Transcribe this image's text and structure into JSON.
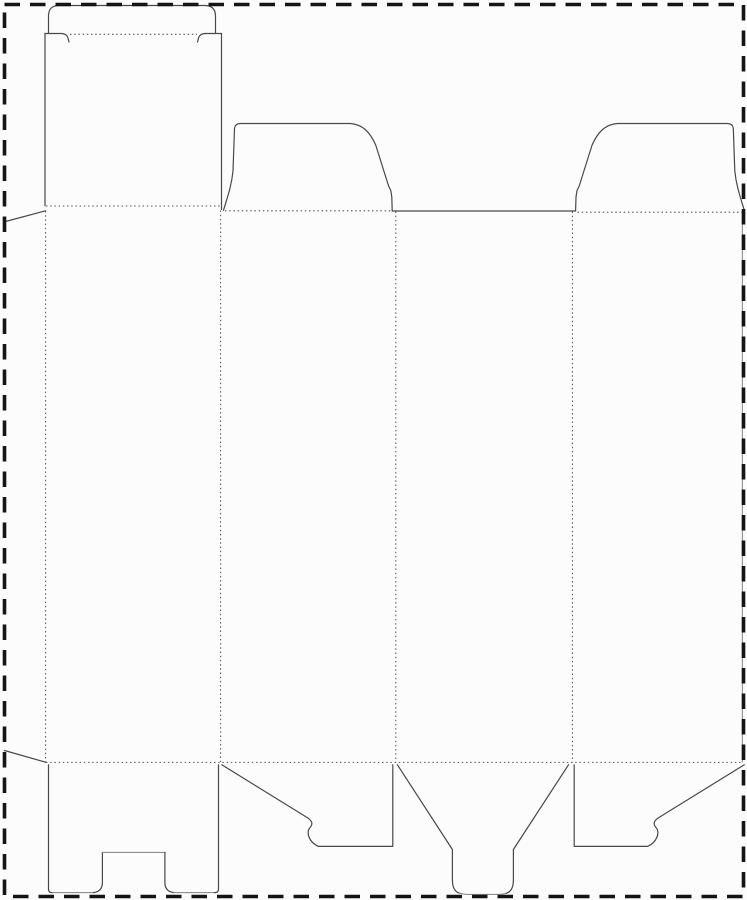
{
  "canvas": {
    "width": 747,
    "height": 900,
    "background": "#fcfcfc"
  },
  "colors": {
    "cut": "#484848",
    "cut_light": "#8e8e8e",
    "fold": "#575757",
    "border": "#151515"
  },
  "sheet_border": {
    "name": "sheet-boundary-border",
    "x": 4.5,
    "y": 4.5,
    "width": 739,
    "height": 892,
    "stroke_width": 3.6,
    "dash": "15.5 10"
  },
  "dieline": {
    "cut_paths": [
      {
        "name": "tuck-flap-outline",
        "d": "M 48.5 33.5 L 48.5 16 Q 48.5 5.5 59 5.5 L 204.5 5.5 Q 215.5 5.5 215.5 16 L 215.5 33.5",
        "light": false
      },
      {
        "name": "tuck-shoulder-left-cut",
        "d": "M 45 33.5 L 61.5 33.5 Q 66.5 33.8 67.8 37.5 L 69 42",
        "light": false
      },
      {
        "name": "tuck-shoulder-right-cut",
        "d": "M 221.5 33.5 L 205 33.5 Q 200 33.8 198.7 37.5 L 197.5 42",
        "light": false
      },
      {
        "name": "top-panel-left-edge",
        "d": "M 45 33.5 L 45 205.8",
        "light": false
      },
      {
        "name": "top-panel-right-edge",
        "d": "M 221.5 33.5 L 221.5 209.5",
        "light": false
      },
      {
        "name": "glue-flap-top-edge",
        "d": "M 45.5 210.8 L 5.5 221.5",
        "light": false
      },
      {
        "name": "glue-flap-bottom-edge",
        "d": "M 4.5 750.5 L 46 762.3",
        "light": false
      },
      {
        "name": "dust-flap-left-outline",
        "d": "M 223.5 210.3 C 227.5 197 231.5 186 233 171 L 234.5 128.5 Q 235 123.5 240.5 123.5 L 350.5 123.5 C 362.5 124.5 370 132 375.7 145 L 388.6 186 L 390.8 190.5 L 391.8 197 L 392.2 210.3",
        "light": false
      },
      {
        "name": "back-panel-top-edge",
        "d": "M 392.2 211 L 575.6 211",
        "light": false
      },
      {
        "name": "dust-flap-right-outline",
        "d": "M 575.6 210.3 L 576 197 L 577 190.5 L 579.2 186 L 592.1 145 C 597.8 132 605.3 124.5 617.3 123.5 L 727.3 123.5 Q 732.8 123.5 733.3 128.5 L 734.8 171 C 736.3 186 740.3 197 744.3 210.3",
        "light": false
      },
      {
        "name": "bottom-flap1-left-edge",
        "d": "M 48.5 764.8 L 48.5 889.5 Q 48.5 892.6 52.5 892.6",
        "light": false
      },
      {
        "name": "bottom-flap1-bottom-left-edge",
        "d": "M 52.5 892.6 L 93.5 892.6",
        "light": true
      },
      {
        "name": "bottom-flap1-notch-left-cut",
        "d": "M 93.5 892.6 Q 102.4 891.5 102.4 882.5 L 102.4 852.4",
        "light": false
      },
      {
        "name": "bottom-flap1-notch-top-cut",
        "d": "M 102.4 852.4 L 164.9 852.4",
        "light": true
      },
      {
        "name": "bottom-flap1-notch-right-cut",
        "d": "M 164.9 852.4 L 164.9 882.5 Q 164.9 891.5 173.8 892.6",
        "light": false
      },
      {
        "name": "bottom-flap1-bottom-right-edge",
        "d": "M 173.8 892.6 L 214.5 892.6",
        "light": true
      },
      {
        "name": "bottom-flap1-right-edge",
        "d": "M 214.5 892.6 Q 218.5 892.6 218.5 889.5 L 218.5 764.8",
        "light": false
      },
      {
        "name": "bottom-flap2-outline",
        "d": "M 221.8 764.8 L 308.3 818.3 C 312 821 313 824 310.5 827 C 308 829.5 307.5 833 309 837 C 310.6 841 313.4 844.2 318.4 846.4 L 392.8 846.4 L 392.8 764.8",
        "light": false
      },
      {
        "name": "bottom-flap3-left-side",
        "d": "M 397.4 764.8 L 452.4 849.5 L 452.4 880 Q 452.4 891 459.5 893.2",
        "light": false
      },
      {
        "name": "bottom-flap3-tongue-bottom",
        "d": "M 459.5 893.2 Q 463 894.4 467 894.4 L 499 894.4 Q 503 894.4 506.4 893.2",
        "light": true
      },
      {
        "name": "bottom-flap3-right-side",
        "d": "M 506.4 893.2 Q 513.4 891 513.4 880 L 513.4 849.5 L 568.5 764.8",
        "light": false
      },
      {
        "name": "bottom-flap4-outline",
        "d": "M 744.3 764.8 L 657.7 818.3 C 654 821 653 824 655.5 827 C 658 829.5 658.5 833 657 837 C 655.4 841 652.6 844.2 647.6 846.4 L 574.2 846.4 L 574.2 764.8",
        "light": false
      },
      {
        "name": "right-panel-outer-edge",
        "d": "M 742.4 212 L 742.4 762",
        "light": true
      }
    ],
    "fold_lines": [
      {
        "name": "tuck-flap-fold",
        "x1": 70,
        "y1": 34.3,
        "x2": 197,
        "y2": 34.3
      },
      {
        "name": "top-panel-fold",
        "x1": 46,
        "y1": 206,
        "x2": 220,
        "y2": 206
      },
      {
        "name": "dust-flap-left-fold",
        "x1": 225,
        "y1": 210.8,
        "x2": 391,
        "y2": 210.8
      },
      {
        "name": "dust-flap-right-fold",
        "x1": 577.5,
        "y1": 212.2,
        "x2": 742,
        "y2": 212.2
      },
      {
        "name": "glue-flap-fold",
        "x1": 45.6,
        "y1": 211,
        "x2": 45.6,
        "y2": 762
      },
      {
        "name": "panel-1-2-fold",
        "x1": 220.6,
        "y1": 210.5,
        "x2": 220.6,
        "y2": 762
      },
      {
        "name": "panel-2-3-fold",
        "x1": 395.8,
        "y1": 211.5,
        "x2": 395.8,
        "y2": 762
      },
      {
        "name": "panel-3-4-fold",
        "x1": 572.4,
        "y1": 211.5,
        "x2": 572.4,
        "y2": 762
      },
      {
        "name": "bottom-flaps-fold",
        "x1": 46,
        "y1": 762.4,
        "x2": 742.5,
        "y2": 762.4
      }
    ],
    "fold_dash": "1.5 2.7",
    "cut_width": 1.2,
    "light_width": 1.1,
    "fold_width": 1.05
  }
}
